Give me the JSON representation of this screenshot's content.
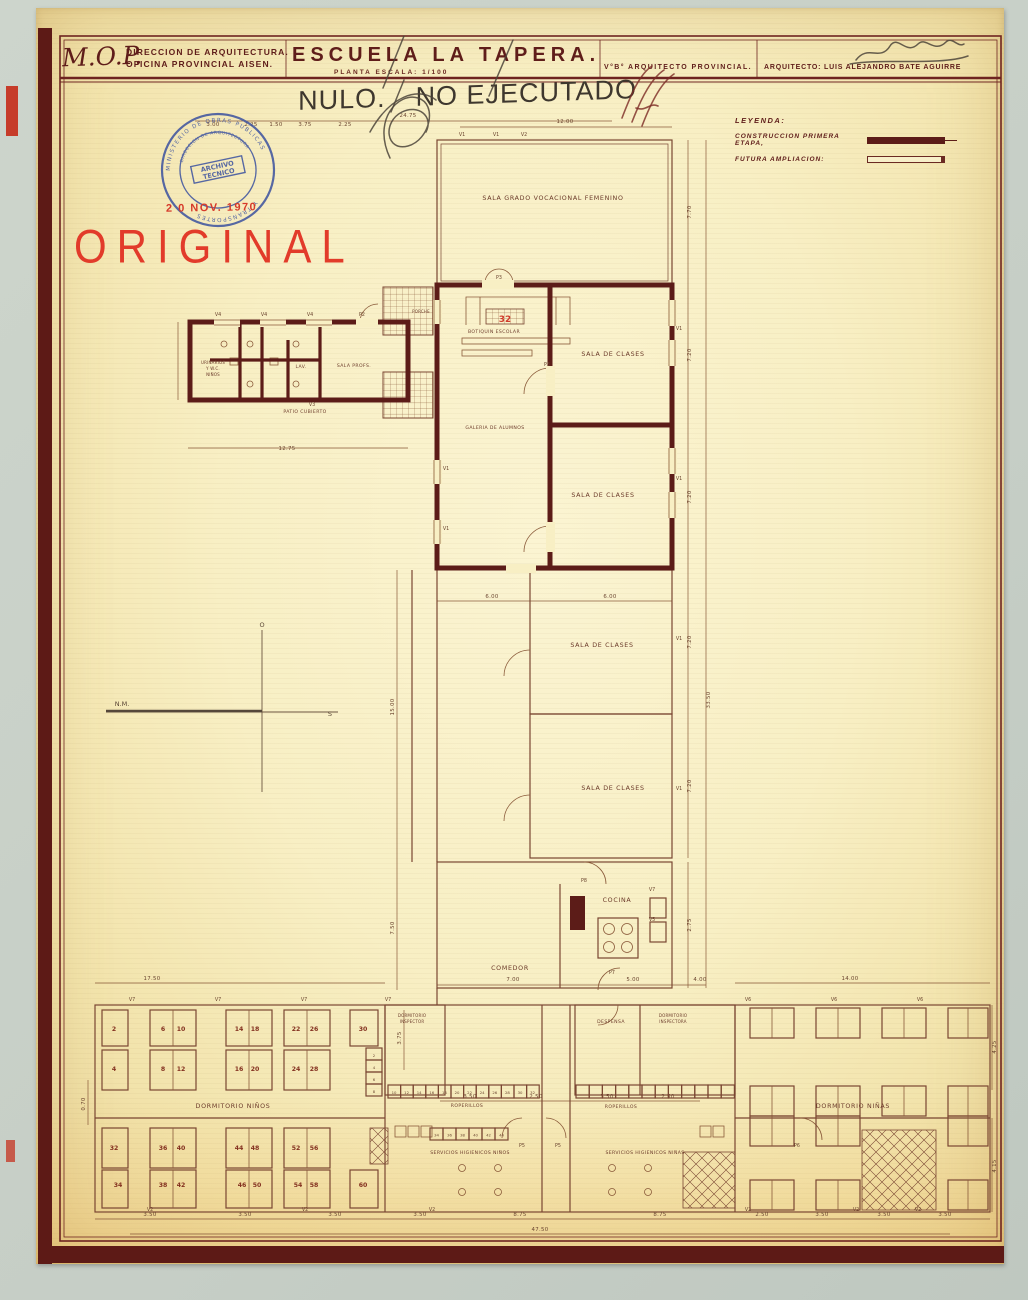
{
  "title_block": {
    "org_abbrev": "M.O.P.",
    "org_line1": "DIRECCION DE ARQUITECTURA.",
    "org_line2": "OFICINA PROVINCIAL AISEN.",
    "project_title": "ESCUELA  LA  TAPERA.",
    "sheet_subtitle": "PLANTA    ESCALA:  1/100",
    "approval_label": "V°B° ARQUITECTO PROVINCIAL.",
    "architect_label": "ARQUITECTO: LUIS ALEJANDRO BATE AGUIRRE"
  },
  "annotations": {
    "nulo_word1": "NULO.",
    "nulo_word2": "NO EJECUTADO",
    "original": "ORIGINAL",
    "date_stamp": "2 0 NOV. 1970",
    "red_number": "32"
  },
  "stamp": {
    "ring_text_top": "MINISTERIO DE OBRAS PUBLICAS",
    "ring_text_bottom": "Y TRANSPORTES",
    "ring_inner": "DIRECCION DE ARQUITECTURA",
    "center_line1": "ARCHIVO",
    "center_line2": "TECNICO"
  },
  "legend": {
    "heading": "LEYENDA:",
    "first_stage": "CONSTRUCCION PRIMERA ETAPA,",
    "future": "FUTURA AMPLIACION:"
  },
  "colors": {
    "wall_maroon": "#5c1c18",
    "thin_line_brown": "#7a4632",
    "stamp_blue": "#4156a0",
    "stamp_red": "#d63a2a",
    "original_red": "#e23b2a",
    "paper_cream": "#f8efc4"
  },
  "plan": {
    "rooms": {
      "sala_grado": "SALA GRADO VOCACIONAL FEMENINO",
      "botiquin": "BOTIQUIN ESCOLAR",
      "sala_clases": "SALA DE CLASES",
      "galeria": "GALERIA DE ALUMNOS",
      "urinarios_lines": [
        "URINARIOS",
        "Y W.C.",
        "NIÑOS"
      ],
      "lav": "LAV.",
      "sala_profs": "SALA PROFS.",
      "porche": "PORCHE",
      "patio": "PATIO CUBIERTO",
      "cocina": "COCINA",
      "comedor": "COMEDOR",
      "dorm_ninos": "DORMITORIO NIÑOS",
      "roperillos": "ROPERILLOS",
      "dorm_inspector_lines": [
        "DORMITORIO",
        "INSPECTOR"
      ],
      "despensa": "DESPENSA",
      "dorm_inspectora_lines": [
        "DORMITORIO",
        "INSPECTORA"
      ],
      "serv_ninos": "SERVICIOS HIGIENICOS NIÑOS",
      "serv_ninas": "SERVICIOS HIGIENICOS NIÑAS",
      "dorm_ninas": "DORMITORIO NIÑAS"
    },
    "compass": {
      "west": "O",
      "south": "S",
      "north_magnetic": "N.M."
    },
    "dims": [
      "24.75",
      "3.00",
      "2.25",
      "1.50",
      "3.75",
      "2.25",
      "12.00",
      "7.70",
      "7.20",
      "7.20",
      "7.20",
      "7.20",
      "33.50",
      "2.75",
      "15.00",
      "7.50",
      "12.75",
      "6.00",
      "6.00",
      "7.00",
      "5.00",
      "4.00",
      "17.50",
      "14.00",
      "3.75",
      "3.50",
      "2.50",
      "3.50",
      "2.50",
      "4.25",
      "4.15",
      "0.70",
      "3.50",
      "3.50",
      "3.50",
      "3.50",
      "8.75",
      "8.75",
      "2.50",
      "3.50",
      "3.50",
      "3.50",
      "47.50"
    ],
    "codes": [
      "V1",
      "V1",
      "V2",
      "P3",
      "V4",
      "V4",
      "V4",
      "P2",
      "V3",
      "P3",
      "V1",
      "V1",
      "V1",
      "V1",
      "V1",
      "V1",
      "P8",
      "V7",
      "V5",
      "P7",
      "V7",
      "V7",
      "V7",
      "V7",
      "V6",
      "V6",
      "V6",
      "P5",
      "P5",
      "P6",
      "V2",
      "V2",
      "V2",
      "V2",
      "V2",
      "V2"
    ],
    "bed_numbers": [
      "2",
      "6",
      "10",
      "14",
      "18",
      "22",
      "26",
      "30",
      "4",
      "8",
      "12",
      "16",
      "20",
      "24",
      "28",
      "32",
      "36",
      "40",
      "44",
      "48",
      "52",
      "56",
      "34",
      "38",
      "42",
      "46",
      "50",
      "54",
      "58",
      "60"
    ],
    "locker_stack": [
      "2",
      "4",
      "6",
      "8"
    ],
    "locker_row1": [
      "10",
      "12",
      "14",
      "16",
      "18",
      "20",
      "22",
      "24",
      "26",
      "28",
      "30",
      "32"
    ],
    "locker_row2": [
      "34",
      "36",
      "38",
      "40",
      "42",
      "44"
    ]
  }
}
